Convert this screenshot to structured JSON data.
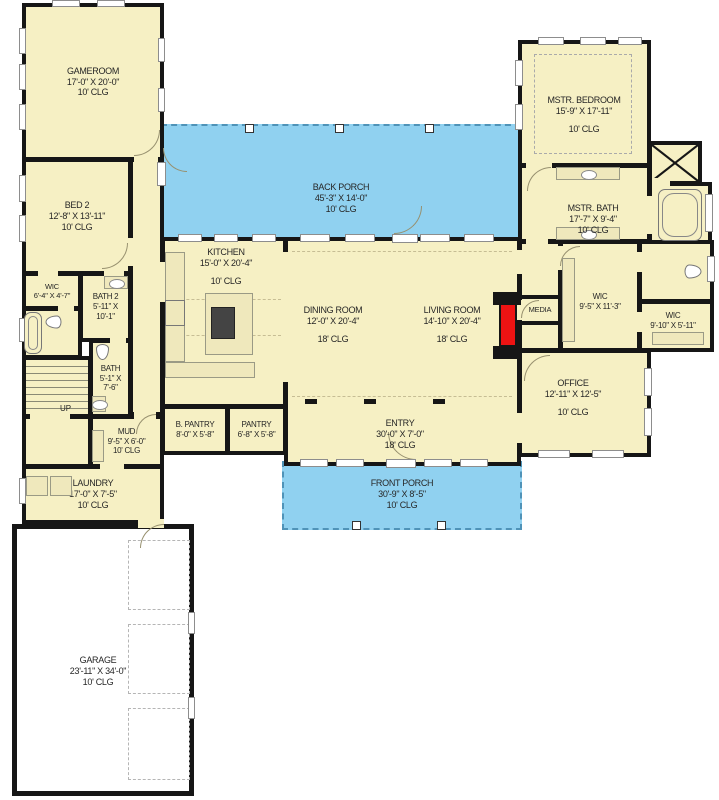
{
  "rooms": {
    "gameroom": {
      "name": "GAMEROOM",
      "dims": "17'-0\" X 20'-0\"",
      "clg": "10' CLG"
    },
    "bed2": {
      "name": "BED 2",
      "dims": "12'-8\" X 13'-11\"",
      "clg": "10' CLG"
    },
    "wic_bed2": {
      "name": "WIC",
      "dims": "6'-4\" X 4'-7\""
    },
    "bath2": {
      "name": "BATH 2",
      "dims1": "5'-11\" X",
      "dims2": "10'-1\""
    },
    "bath": {
      "name": "BATH",
      "dims1": "5'-1\" X",
      "dims2": "7'-6\""
    },
    "stairs": {
      "name": "UP"
    },
    "mud": {
      "name": "MUD",
      "dims": "9'-5\" X 6'-0\"",
      "clg": "10' CLG"
    },
    "laundry": {
      "name": "LAUNDRY",
      "dims": "17'-0\" X 7'-5\"",
      "clg": "10' CLG"
    },
    "garage": {
      "name": "GARAGE",
      "dims": "23'-11\" X 34'-0\"",
      "clg": "10' CLG"
    },
    "back_porch": {
      "name": "BACK PORCH",
      "dims": "45'-3\" X 14'-0\"",
      "clg": "10' CLG"
    },
    "front_porch": {
      "name": "FRONT PORCH",
      "dims": "30'-9\" X 8'-5\"",
      "clg": "10' CLG"
    },
    "kitchen": {
      "name": "KITCHEN",
      "dims": "15'-0\" X 20'-4\"",
      "clg": "10' CLG"
    },
    "dining": {
      "name": "DINING ROOM",
      "dims": "12'-0\" X 20'-4\"",
      "clg": "18' CLG"
    },
    "living": {
      "name": "LIVING ROOM",
      "dims": "14'-10\" X 20'-4\"",
      "clg": "18' CLG"
    },
    "entry": {
      "name": "ENTRY",
      "dims": "30'-0\" X 7'-0\"",
      "clg": "18' CLG"
    },
    "b_pantry": {
      "name": "B. PANTRY",
      "dims": "8'-0\" X 5'-8\""
    },
    "pantry": {
      "name": "PANTRY",
      "dims": "6'-8\" X 5'-8\""
    },
    "mstr_bedroom": {
      "name": "MSTR. BEDROOM",
      "dims": "15'-9\" X 17'-11\"",
      "clg": "10' CLG"
    },
    "mstr_bath": {
      "name": "MSTR. BATH",
      "dims": "17'-7\" X 9'-4\"",
      "clg": "10' CLG"
    },
    "media": {
      "name": "MEDIA"
    },
    "wic_mstr": {
      "name": "WIC",
      "dims": "9'-5\" X 11'-3\""
    },
    "wic2": {
      "name": "WIC",
      "dims": "9'-10\" X 5'-11\""
    },
    "office": {
      "name": "OFFICE",
      "dims": "12'-11\" X 12'-5\"",
      "clg": "10' CLG"
    }
  },
  "colors": {
    "room_fill": "#F6F0C4",
    "porch_fill": "#90D1F0",
    "wall": "#161616",
    "fireplace_accent": "#EE1313",
    "fixture_fill": "#EFE8BC"
  }
}
